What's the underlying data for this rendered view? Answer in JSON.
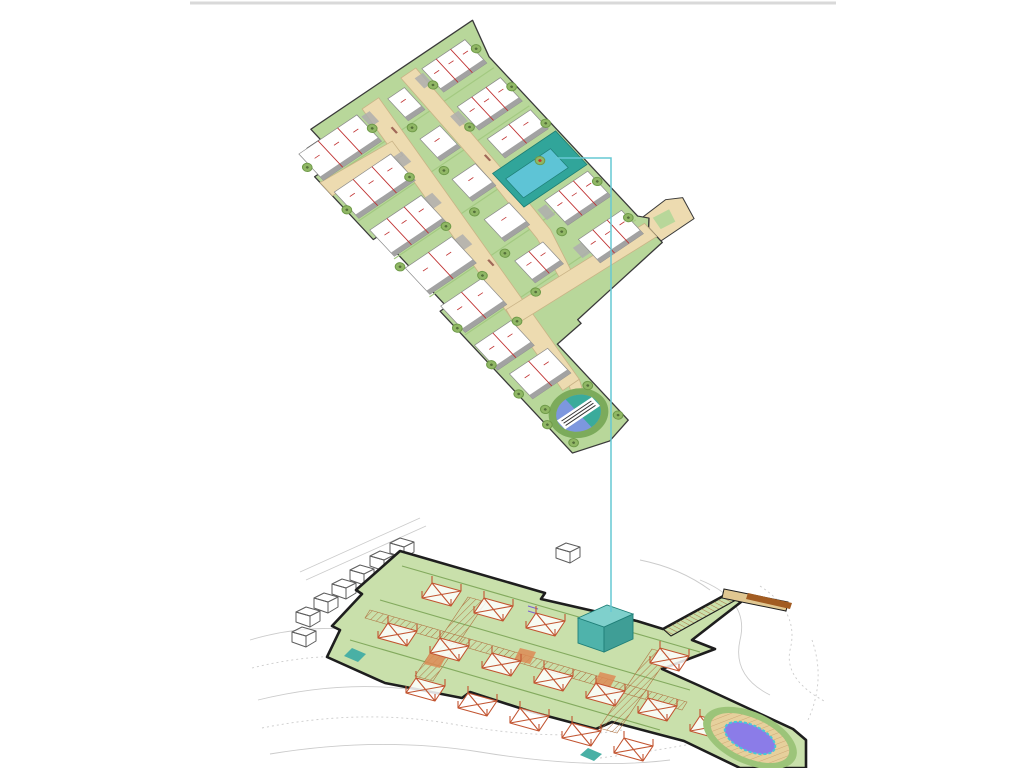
{
  "colors": {
    "bg": "#ffffff",
    "frame_line": "#d9d9d9",
    "plan_green": "#b8d79a",
    "hedge_green": "#a3c981",
    "outline_dark": "#3a3a3a",
    "road_fill": "#eddbb0",
    "road_stroke": "#c9b386",
    "road_smudge": "#a06858",
    "building_fill": "#ffffff",
    "building_stroke": "#8a8a8a",
    "building_shadow": "#a2a2a2",
    "divider_red": "#c03030",
    "pad_gray": "#aeaeae",
    "tree_fill": "#90b765",
    "tree_stroke": "#6e9a48",
    "tree_core": "#546f3a",
    "highlight_plot": "#31a59a",
    "highlight_building": "#5ec4d6",
    "highlight_stroke": "#1d7d74",
    "pool_ring": "#7cab5b",
    "pool_blue": "#7d97de",
    "pool_teal": "#3aab9b",
    "connector_cyan": "#67c8d4",
    "contour_gray": "#cbcbcb",
    "platform_green": "#c9e0ab",
    "platform_outline": "#1e1e1e",
    "terrace_line": "#83aa5e",
    "wire_red": "#c25430",
    "hatch_brown": "#b07645",
    "ramp_bar": "#a25c22",
    "landing_fill": "#e0c791",
    "context_gray": "#5d5d5d",
    "tealbox_top": "#7fd0cc",
    "tealbox_left": "#4fb3ab",
    "tealbox_right": "#3f9e96",
    "tealbox_stroke": "#1f7f78",
    "accent_orange": "#dd8a55",
    "teal_accent": "#49b0a5",
    "accent_purple": "#7a5fd0",
    "deck_ring": "#9cc479",
    "deck_tan": "#e6d09c",
    "pool3d_purple": "#8b7ce8",
    "pool3d_rim": "#46c8d8"
  },
  "site_plan": {
    "building_strips": [
      {
        "x": 4,
        "y": 14,
        "w": 70,
        "h": 36,
        "u": 3
      },
      {
        "x": 4,
        "y": 66,
        "w": 68,
        "h": 36,
        "u": 3
      },
      {
        "x": 4,
        "y": 118,
        "w": 62,
        "h": 36,
        "u": 3
      },
      {
        "x": 4,
        "y": 170,
        "w": 56,
        "h": 36,
        "u": 2
      },
      {
        "x": 4,
        "y": 222,
        "w": 50,
        "h": 36,
        "u": 2
      },
      {
        "x": 2,
        "y": 274,
        "w": 44,
        "h": 34,
        "u": 2
      },
      {
        "x": 8,
        "y": 318,
        "w": 46,
        "h": 34,
        "u": 2
      },
      {
        "x": 108,
        "y": 18,
        "w": 20,
        "h": 30,
        "u": 1
      },
      {
        "x": 104,
        "y": 70,
        "w": 24,
        "h": 30,
        "u": 1
      },
      {
        "x": 100,
        "y": 122,
        "w": 28,
        "h": 30,
        "u": 1
      },
      {
        "x": 96,
        "y": 174,
        "w": 30,
        "h": 30,
        "u": 1
      },
      {
        "x": 90,
        "y": 226,
        "w": 34,
        "h": 30,
        "u": 2
      },
      {
        "x": 154,
        "y": 12,
        "w": 52,
        "h": 32,
        "u": 3
      },
      {
        "x": 154,
        "y": 64,
        "w": 52,
        "h": 32,
        "u": 3
      },
      {
        "x": 154,
        "y": 108,
        "w": 52,
        "h": 26,
        "u": 2
      },
      {
        "x": 154,
        "y": 192,
        "w": 52,
        "h": 34,
        "u": 3
      },
      {
        "x": 152,
        "y": 244,
        "w": 52,
        "h": 32,
        "u": 3
      }
    ],
    "pads": [
      [
        76,
        18
      ],
      [
        72,
        70
      ],
      [
        66,
        122
      ],
      [
        60,
        174
      ],
      [
        142,
        16
      ],
      [
        142,
        68
      ],
      [
        142,
        196
      ],
      [
        142,
        248
      ]
    ],
    "trees": [
      [
        1,
        30
      ],
      [
        1,
        88
      ],
      [
        1,
        166
      ],
      [
        1,
        250
      ],
      [
        1,
        300
      ],
      [
        1,
        340
      ],
      [
        1,
        382
      ],
      [
        76,
        34
      ],
      [
        70,
        96
      ],
      [
        63,
        158
      ],
      [
        56,
        220
      ],
      [
        50,
        278
      ],
      [
        106,
        56
      ],
      [
        100,
        110
      ],
      [
        94,
        162
      ],
      [
        88,
        214
      ],
      [
        84,
        264
      ],
      [
        151,
        32
      ],
      [
        149,
        88
      ],
      [
        145,
        228
      ],
      [
        208,
        26
      ],
      [
        208,
        78
      ],
      [
        208,
        128
      ],
      [
        206,
        206
      ],
      [
        204,
        254
      ],
      [
        10,
        368
      ],
      [
        58,
        372
      ],
      [
        8,
        412
      ],
      [
        60,
        414
      ]
    ],
    "accent_tree": [
      178,
      156
    ],
    "road_smudges": [
      [
        90,
        44
      ],
      [
        70,
        210
      ],
      [
        140,
        120
      ]
    ]
  },
  "connector_points": "556,158 611,158 611,612",
  "frame_line": {
    "x1": 190,
    "y1": 3,
    "x2": 836,
    "y2": 3
  },
  "axo": {
    "houses": [
      [
        432,
        583
      ],
      [
        484,
        598
      ],
      [
        536,
        613
      ],
      [
        660,
        648
      ],
      [
        388,
        623
      ],
      [
        440,
        638
      ],
      [
        492,
        653
      ],
      [
        544,
        668
      ],
      [
        596,
        683
      ],
      [
        648,
        698
      ],
      [
        416,
        678
      ],
      [
        468,
        693
      ],
      [
        520,
        708
      ],
      [
        572,
        723
      ],
      [
        624,
        738
      ],
      [
        700,
        716
      ]
    ],
    "context_houses": [
      [
        296,
        612
      ],
      [
        314,
        598
      ],
      [
        332,
        584
      ],
      [
        350,
        570
      ],
      [
        370,
        556
      ],
      [
        390,
        543
      ],
      [
        292,
        632
      ],
      [
        556,
        548
      ]
    ],
    "contours": [
      "M250,640 q60,-18 120,-8 q70,12 112,2",
      "M252,668 q80,-20 150,-6 q80,14 130,4",
      "M258,700 q90,-22 170,-8 q90,16 150,2",
      "M262,728 q100,-20 190,-4 q100,18 170,6",
      "M270,754 q110,-18 210,-2 q110,18 190,8",
      "M600,758 q80,-10 150,-26",
      "M700,580 q50,20 40,60 q-8,36 30,55",
      "M760,586 q40,26 30,64 q-6,30 36,52",
      "M640,560 q40,8 70,30",
      "M812,640 q14,40 -4,80"
    ],
    "faint_lines": [
      "M300,572 L420,518",
      "M306,580 L426,526"
    ],
    "patios": [
      "M520,648 L536,652 L530,664 L514,660 Z",
      "M600,672 L616,676 L610,688 L594,684 Z",
      "M430,652 L446,656 L440,668 L424,664 Z"
    ],
    "teal_accents": [
      "M352,648 L366,654 L358,662 L344,656 Z",
      "M588,748 L602,754 L594,761 L580,755 Z"
    ]
  }
}
